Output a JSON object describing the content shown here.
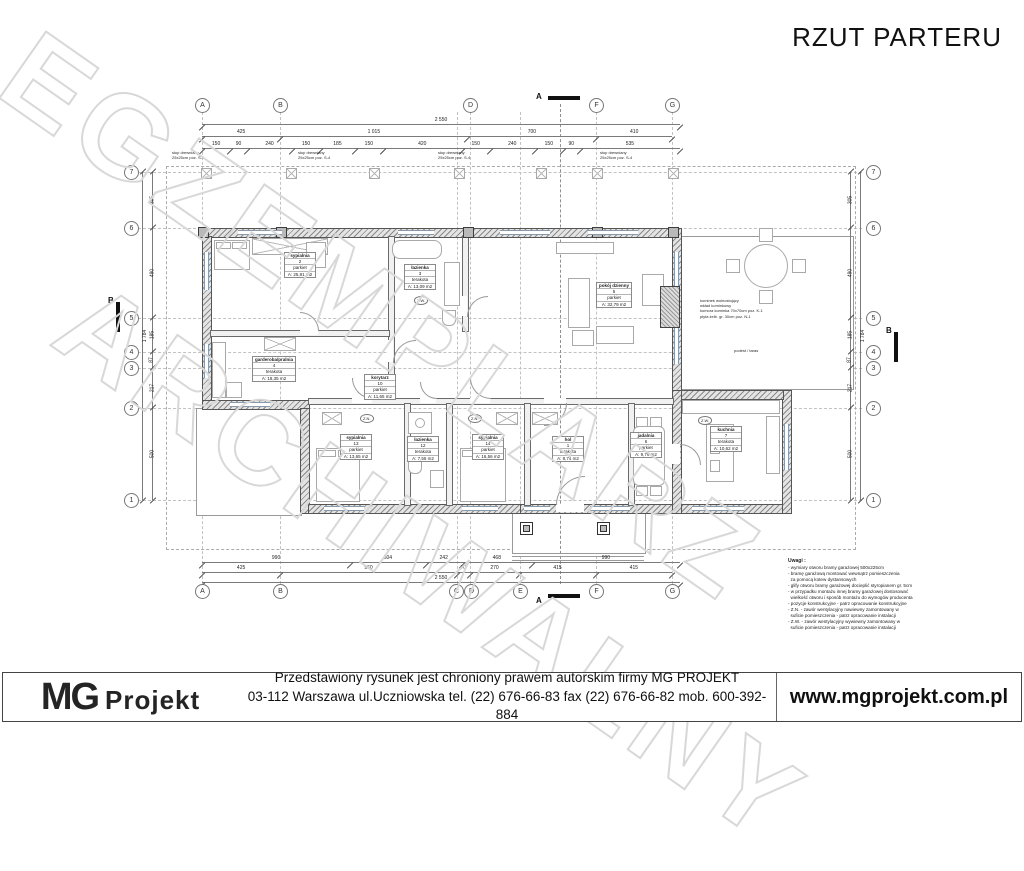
{
  "watermark": {
    "line1": "EGZEMPLARZ",
    "line2": "ARCHIWALNY"
  },
  "title": "RZUT PARTERU",
  "axes": {
    "top": [
      "A",
      "B",
      "D",
      "F",
      "G"
    ],
    "bottom": [
      "A",
      "B",
      "C",
      "D",
      "E",
      "F",
      "G"
    ],
    "left": [
      "7",
      "6",
      "5",
      "4",
      "3",
      "2",
      "1"
    ],
    "right": [
      "7",
      "6",
      "5",
      "4",
      "3",
      "2",
      "1"
    ]
  },
  "sections": {
    "a": "A",
    "b": "B"
  },
  "rooms": [
    {
      "name": "sypialnia",
      "num": "2",
      "floor": "parkiet",
      "area": "A: 25,91 m2"
    },
    {
      "name": "łazienka",
      "num": "3",
      "floor": "terakota",
      "area": "A: 13,09 m2"
    },
    {
      "name": "pokój dzienny",
      "num": "5",
      "floor": "parkiet",
      "area": "A: 32,79 m2"
    },
    {
      "name": "garderoba/pralnia",
      "num": "4",
      "floor": "terakota",
      "area": "A: 18,35 m2"
    },
    {
      "name": "korytarz",
      "num": "10",
      "floor": "parkiet",
      "area": "A: 11,65 m2"
    },
    {
      "name": "sypialnia",
      "num": "13",
      "floor": "parkiet",
      "area": "A: 13,65 m2"
    },
    {
      "name": "łazienka",
      "num": "12",
      "floor": "terakota",
      "area": "A: 7,55 m2"
    },
    {
      "name": "sypialnia",
      "num": "14",
      "floor": "parkiet",
      "area": "A: 16,56 m2"
    },
    {
      "name": "hol",
      "num": "1",
      "floor": "terakota",
      "area": "A: 8,74 m2"
    },
    {
      "name": "jadalnia",
      "num": "6",
      "floor": "parkiet",
      "area": "A: 9,79 m2"
    },
    {
      "name": "kuchnia",
      "num": "7",
      "floor": "terakota",
      "area": "A: 10,62 m2"
    }
  ],
  "dims": {
    "top_total": [
      "2 550"
    ],
    "top_axes": [
      "425",
      "1 015",
      "700",
      "410"
    ],
    "top_detail": [
      "150",
      "90",
      "240",
      "150",
      "185",
      "150",
      "420",
      "150",
      "240",
      "150",
      "90",
      "535"
    ],
    "bottom_detail": [
      "990",
      "504",
      "242",
      "468",
      "990"
    ],
    "bottom_axes": [
      "425",
      "960",
      "70",
      "270",
      "415",
      "415"
    ],
    "bottom_total": [
      "2 550"
    ],
    "left_axes": [
      "305",
      "490",
      "185",
      "87",
      "217",
      "500"
    ],
    "left_total": [
      "1 784"
    ],
    "right_axes": [
      "305",
      "490",
      "185",
      "87",
      "217",
      "500"
    ],
    "right_total": [
      "1 784"
    ]
  },
  "annotations": {
    "post_l1": "słup drewniany",
    "post_l2": "25x25cm poz. S-4",
    "fireplace": [
      "kominek wolnostojący",
      "wkład kominkowy",
      "komora kominka 70x70cm poz. K-1",
      "płyta żelb. gr. 30cm poz. N-1"
    ],
    "terrace": "podest / taras",
    "vent_zn": "Z.N.",
    "vent_zw": "Z.W."
  },
  "legend": {
    "title": "Uwagi :",
    "lines": [
      "- wymiary otworu bramy garażowej 500x225cm",
      "- bramę garażową montować wewnątrz pomieszczenia",
      "  za pomocą kotew dystansowych",
      "- glify otworu bramy garażowej docieplić styropianem gr. 5cm",
      "- w przypadku montażu innej bramy garażowej dostosować",
      "  wielkość otworu i sposób montażu do wymogów producenta",
      "- pozycje konstrukcyjne - patrz opracowanie konstrukcyjne",
      "- Z.N. - zawór wentylacyjny nawiewny zamontowany w",
      "  suficie pomieszczenia - patrz opracowanie instalacji",
      "- Z.W. - zawór wentylacyjny wywiewny zamontowany w",
      "  suficie pomieszczenia - patrz opracowanie instalacji"
    ]
  },
  "footer": {
    "logo_mg": "MG",
    "logo_projekt": "Projekt",
    "line1": "Przedstawiony rysunek jest chroniony prawem autorskim firmy MG PROJEKT",
    "line2": "03-112 Warszawa ul.Uczniowska   tel. (22) 676-66-83 fax (22) 676-66-82 mob. 600-392-884",
    "url": "www.mgprojekt.com.pl"
  }
}
